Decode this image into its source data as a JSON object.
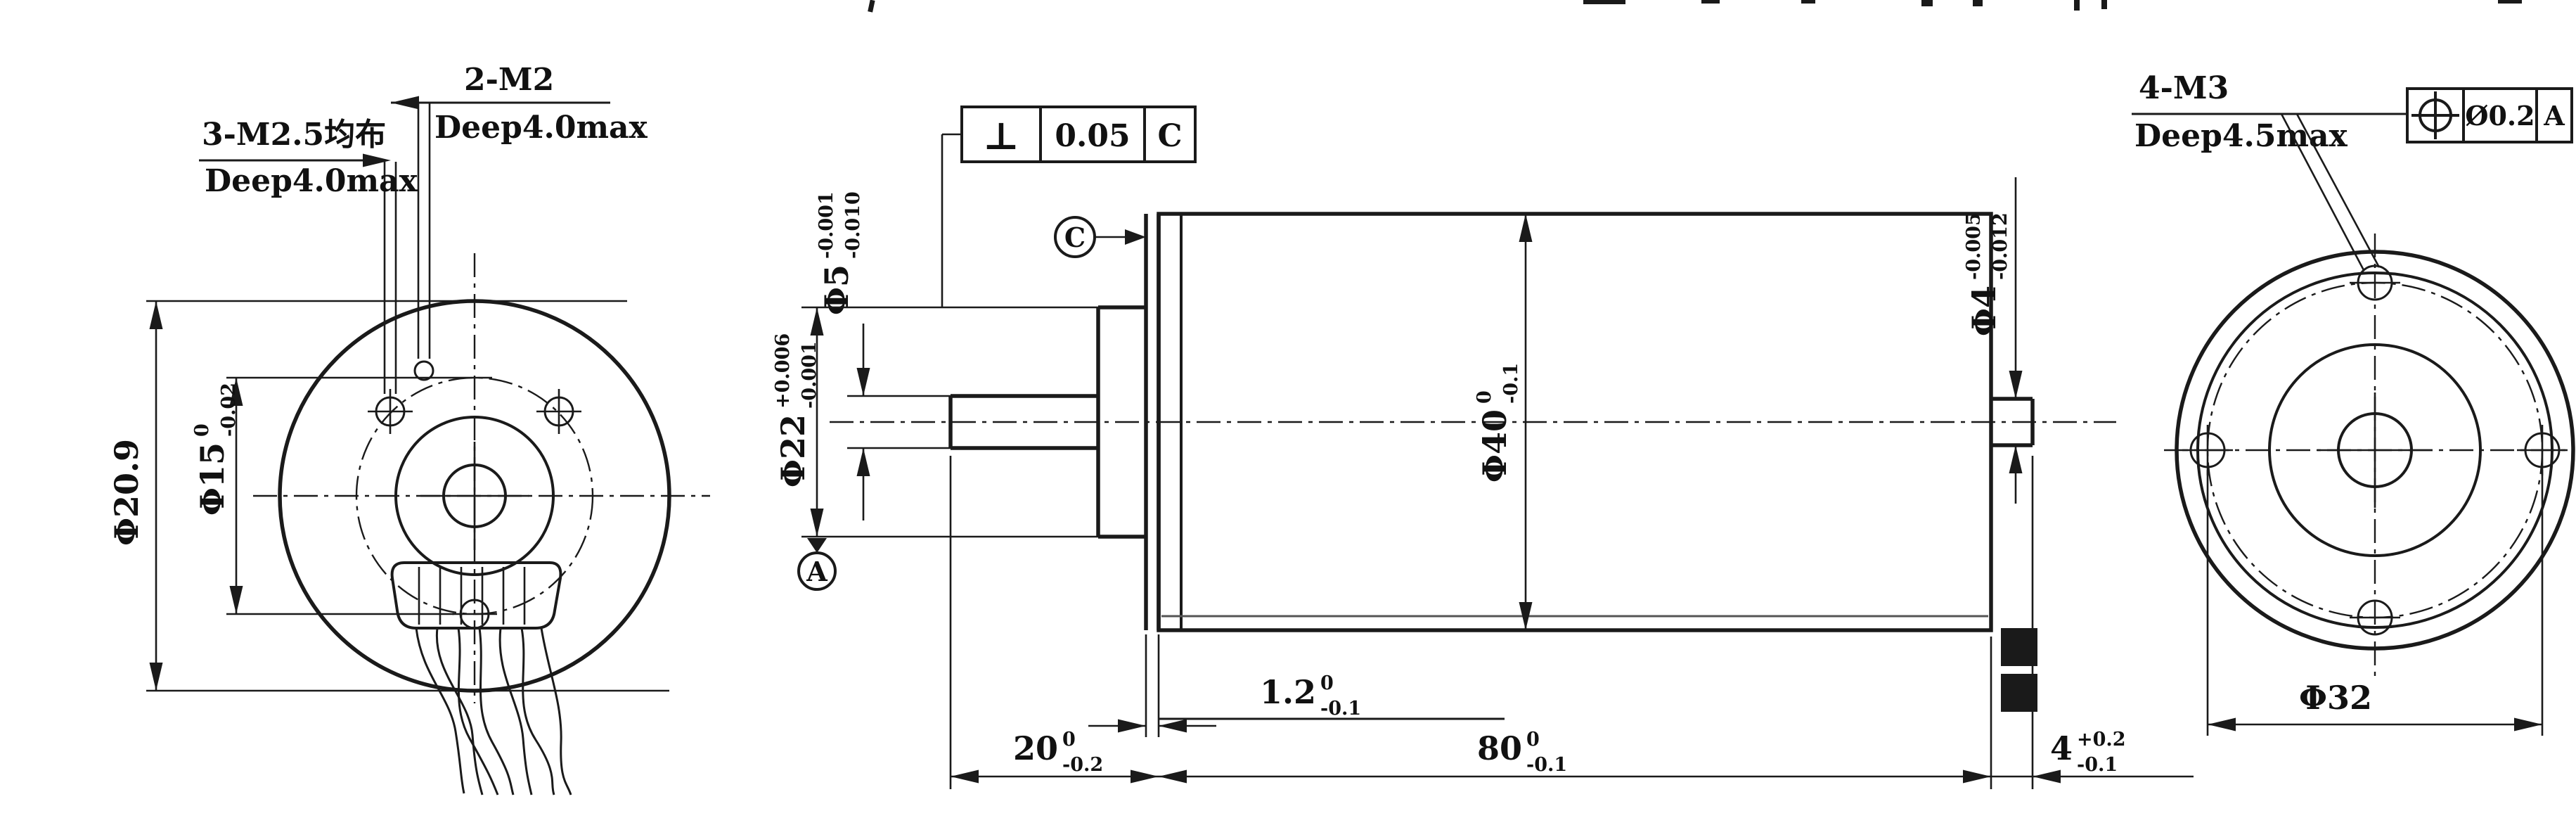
{
  "views": {
    "left": {
      "callout_m25_line1": "3-M2.5均布",
      "callout_m25_line2": "Deep4.0max",
      "callout_m2_line1": "2-M2",
      "callout_m2_line2": "Deep4.0max",
      "dim_d209": "Φ20.9",
      "dim_d15_main": "Φ15",
      "dim_d15_upper": "0",
      "dim_d15_lower": "-0.02"
    },
    "side": {
      "fcf_perp_symbol": "⊥",
      "fcf_perp_value": "0.05",
      "fcf_perp_datum": "C",
      "datum_c": "C",
      "datum_a": "A",
      "dim_d5_main": "Φ5",
      "dim_d5_upper": "-0.001",
      "dim_d5_lower": "-0.010",
      "dim_d22_main": "Φ22",
      "dim_d22_upper": "+0.006",
      "dim_d22_lower": "-0.001",
      "dim_d40_main": "Φ40",
      "dim_d40_upper": "0",
      "dim_d40_lower": "-0.1",
      "dim_d4_main": "Φ4",
      "dim_d4_upper": "-0.005",
      "dim_d4_lower": "-0.012",
      "dim_20_main": "20",
      "dim_20_upper": "0",
      "dim_20_lower": "-0.2",
      "dim_12_main": "1.2",
      "dim_12_upper": "0",
      "dim_12_lower": "-0.1",
      "dim_80_main": "80",
      "dim_80_upper": "0",
      "dim_80_lower": "-0.1",
      "dim_4_main": "4",
      "dim_4_upper": "+0.2",
      "dim_4_lower": "-0.1"
    },
    "right": {
      "callout_m3_line1": "4-M3",
      "callout_m3_line2": "Deep4.5max",
      "fcf_pos_symbol": "position",
      "fcf_pos_value": "Ø0.2",
      "fcf_pos_datum": "A",
      "dim_d32": "Φ32"
    },
    "colors": {
      "line": "#1a1a1a",
      "background": "#ffffff"
    }
  }
}
